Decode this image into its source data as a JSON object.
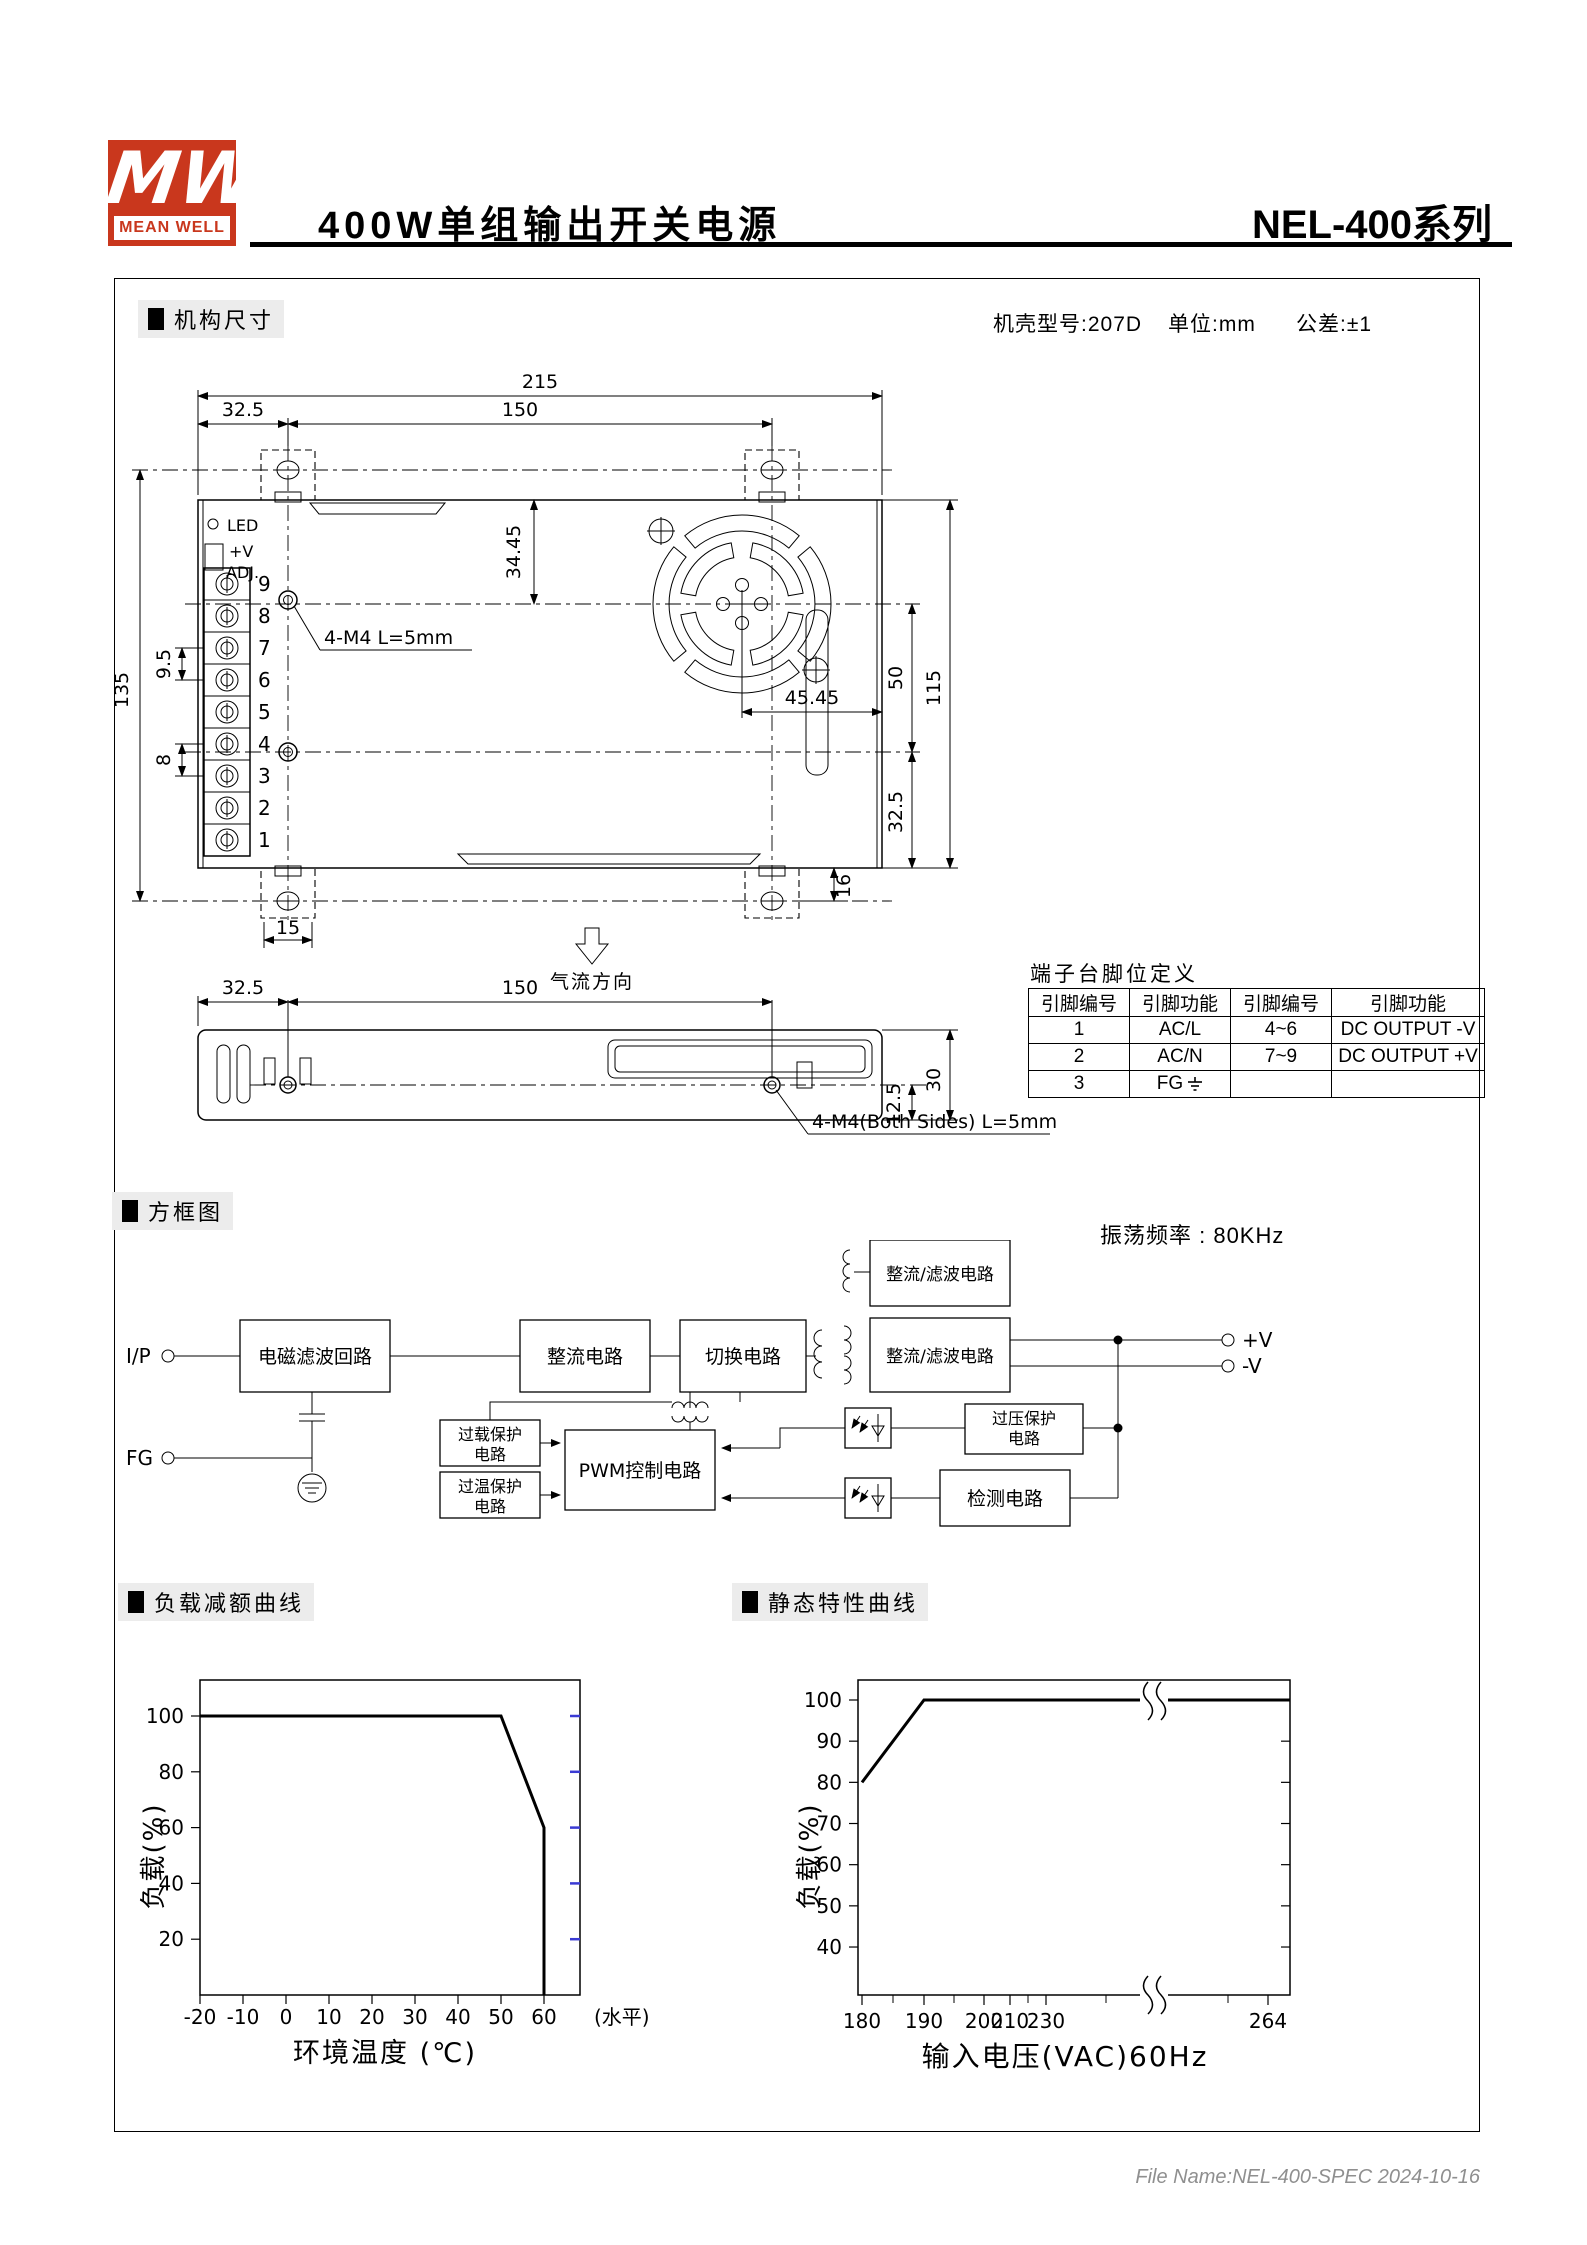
{
  "header": {
    "logo_mw": "MW",
    "logo_text": "MEAN WELL",
    "title": "400W单组输出开关电源",
    "series": "NEL-400系列"
  },
  "mech": {
    "section_title": "机构尺寸",
    "case_model": "机壳型号:207D",
    "unit": "单位:mm",
    "tolerance": "公差:±1",
    "dims": {
      "top_width": "215",
      "left_offset": "32.5",
      "hole_span": "150",
      "height": "135",
      "pitch_a": "9.5",
      "pitch_b": "8",
      "bracket_w": "15",
      "fan_top": "34.45",
      "fan_right": "45.45",
      "right_a": "50",
      "case_h": "115",
      "right_b": "32.5",
      "tab": "16",
      "side_h": "30",
      "side_hole": "12.5",
      "side_left": "32.5",
      "side_span": "150"
    },
    "labels": {
      "led": "LED",
      "vplus": "+V",
      "adj": "ADJ.",
      "screw_note_top": "4-M4 L=5mm",
      "screw_note_side": "4-M4(Both Sides) L=5mm",
      "airflow": "气流方向",
      "terminal_numbers": [
        "9",
        "8",
        "7",
        "6",
        "5",
        "4",
        "3",
        "2",
        "1"
      ]
    }
  },
  "pin_table": {
    "title": "端子台脚位定义",
    "headers": [
      "引脚编号",
      "引脚功能",
      "引脚编号",
      "引脚功能"
    ],
    "rows": [
      [
        "1",
        "AC/L",
        "4~6",
        "DC OUTPUT -V"
      ],
      [
        "2",
        "AC/N",
        "7~9",
        "DC OUTPUT +V"
      ],
      [
        "3",
        "FG",
        "",
        ""
      ]
    ]
  },
  "block": {
    "section_title": "方框图",
    "osc": "振荡频率 : 80KHz",
    "ip": "I/P",
    "fg": "FG",
    "vplus": "+V",
    "vminus": "-V",
    "boxes": {
      "emi": "电磁滤波回路",
      "rectifier": "整流电路",
      "switching": "切换电路",
      "rect_filter_top": "整流/滤波电路",
      "rect_filter_main": "整流/滤波电路",
      "pwm": "PWM控制电路",
      "overload_1": "过载保护",
      "overload_2": "电路",
      "overtemp_1": "过温保护",
      "overtemp_2": "电路",
      "ovp_1": "过压保护",
      "ovp_2": "电路",
      "detect": "检测电路"
    }
  },
  "charts": {
    "derating_title": "负载减额曲线",
    "static_title": "静态特性曲线"
  },
  "chart_data": [
    {
      "type": "line",
      "title": "负载减额曲线",
      "xlabel": "环境温度 (℃)",
      "x_axis_suffix": "(水平)",
      "ylabel": "负载(%)",
      "x_ticks": [
        -20,
        -10,
        0,
        10,
        20,
        30,
        40,
        50,
        60
      ],
      "y_ticks": [
        20,
        40,
        60,
        80,
        100
      ],
      "xlim": [
        -20,
        68
      ],
      "ylim": [
        0,
        113
      ],
      "grid": false,
      "legend": "none",
      "points": [
        [
          -20,
          100
        ],
        [
          50,
          100
        ],
        [
          60,
          60
        ],
        [
          60,
          0
        ]
      ],
      "right_tick_color": "#3b3bd4"
    },
    {
      "type": "line",
      "title": "静态特性曲线",
      "xlabel": "输入电压(VAC)60Hz",
      "ylabel": "负载(%)",
      "x_ticks": [
        180,
        190,
        200,
        210,
        230,
        264
      ],
      "y_ticks": [
        40,
        50,
        60,
        70,
        80,
        90,
        100
      ],
      "axis_break_between": [
        230,
        264
      ],
      "grid": false,
      "legend": "none",
      "points": [
        [
          180,
          80
        ],
        [
          190,
          100
        ],
        [
          264,
          100
        ]
      ]
    }
  ],
  "footer": {
    "file_name": "File Name:NEL-400-SPEC  2024-10-16"
  }
}
